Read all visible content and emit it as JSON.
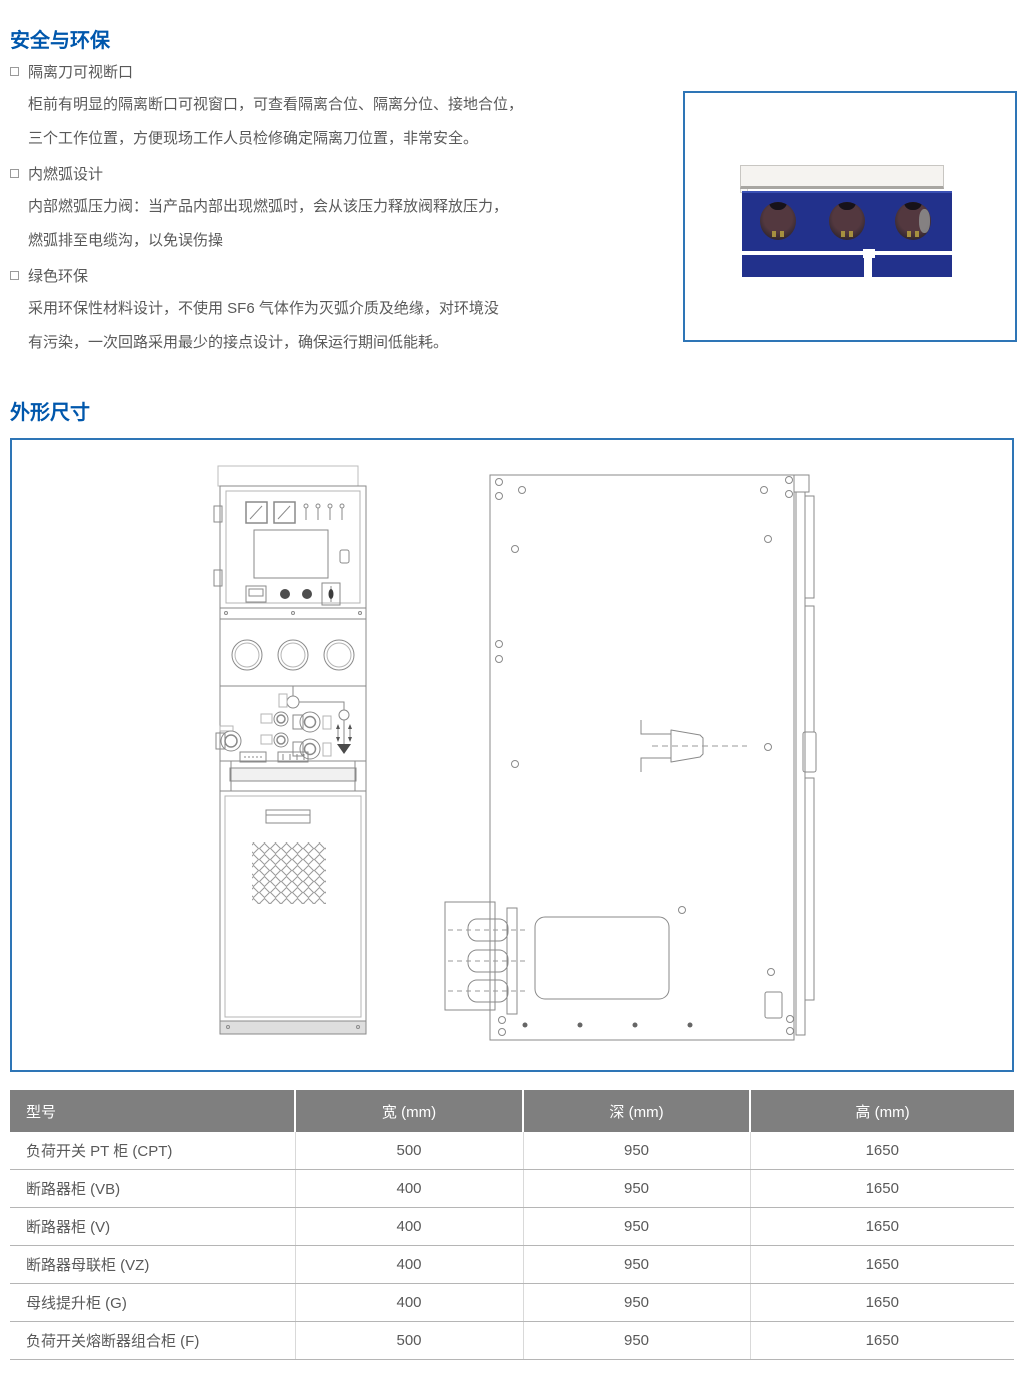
{
  "colors": {
    "accent_blue": "#0057ac",
    "box_border_blue": "#2e75b6",
    "navy_panel": "#22318c",
    "table_header_bg": "#7f7f7f",
    "body_text_gray": "#595959"
  },
  "safety_section": {
    "title": "安全与环保",
    "items": [
      {
        "title": "隔离刀可视断口",
        "line1": "柜前有明显的隔离断口可视窗口，可查看隔离合位、隔离分位、接地合位，",
        "line2": "三个工作位置，方便现场工作人员检修确定隔离刀位置，非常安全。"
      },
      {
        "title": "内燃弧设计",
        "line1": "内部燃弧压力阀：当产品内部出现燃弧时，会从该压力释放阀释放压力，",
        "line2": "燃弧排至电缆沟，以免误伤操"
      },
      {
        "title": "绿色环保",
        "line1": "采用环保性材料设计，不使用 SF6 气体作为灭弧介质及绝缘，对环境没",
        "line2": "有污染，一次回路采用最少的接点设计，确保运行期间低能耗。"
      }
    ]
  },
  "dimensions_section": {
    "title": "外形尺寸"
  },
  "table": {
    "headers": [
      "型号",
      "宽 (mm)",
      "深 (mm)",
      "高 (mm)"
    ],
    "rows": [
      [
        "负荷开关 PT 柜 (CPT)",
        "500",
        "950",
        "1650"
      ],
      [
        "断路器柜 (VB)",
        "400",
        "950",
        "1650"
      ],
      [
        "断路器柜 (V)",
        "400",
        "950",
        "1650"
      ],
      [
        "断路器母联柜 (VZ)",
        "400",
        "950",
        "1650"
      ],
      [
        "母线提升柜 (G)",
        "400",
        "950",
        "1650"
      ],
      [
        "负荷开关熔断器组合柜 (F)",
        "500",
        "950",
        "1650"
      ]
    ]
  }
}
